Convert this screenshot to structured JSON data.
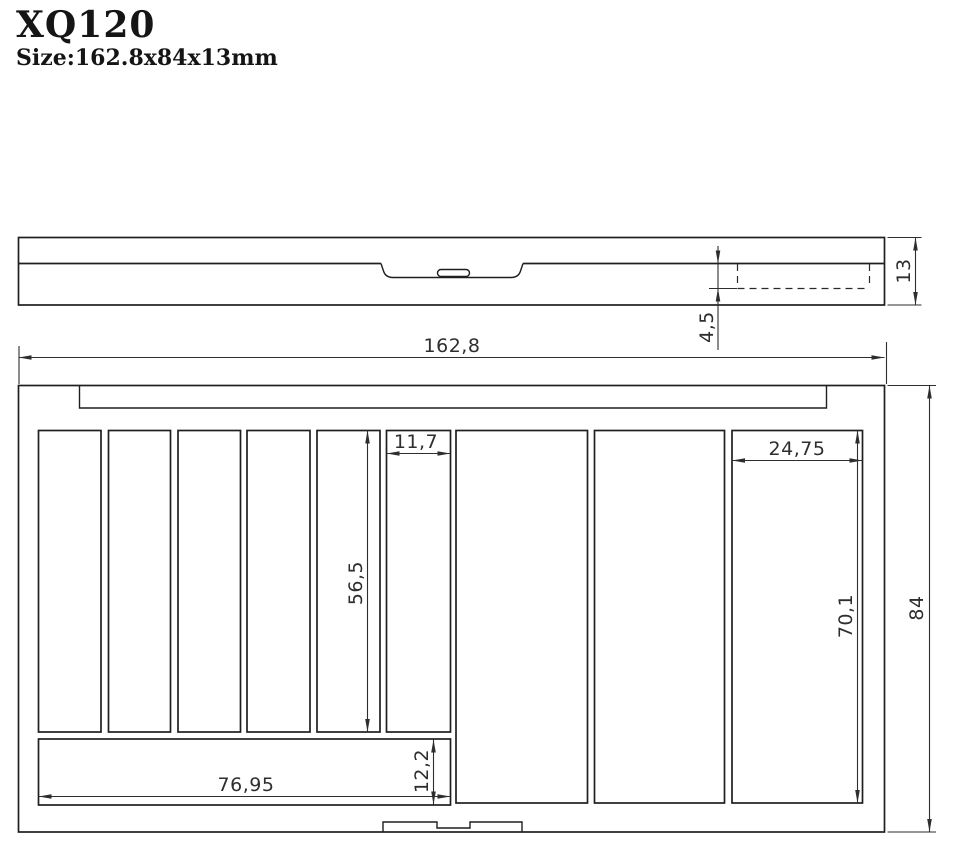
{
  "header": {
    "model": "XQ120",
    "size_label": "Size:162.8x84x13mm"
  },
  "colors": {
    "background": "#ffffff",
    "line": "#1f1f1f",
    "dimension": "#2e2e2e"
  },
  "side_view": {
    "dim_thickness": "13",
    "dim_lip_depth": "4,5"
  },
  "plan_view": {
    "dim_overall_width": "162,8",
    "dim_overall_depth": "84",
    "dim_slot_width": "11,7",
    "dim_slot_length": "56,5",
    "dim_right_slot_width": "24,75",
    "dim_right_slot_length": "70,1",
    "dim_bottom_slot_length": "76,95",
    "dim_bottom_slot_width": "12,2"
  }
}
